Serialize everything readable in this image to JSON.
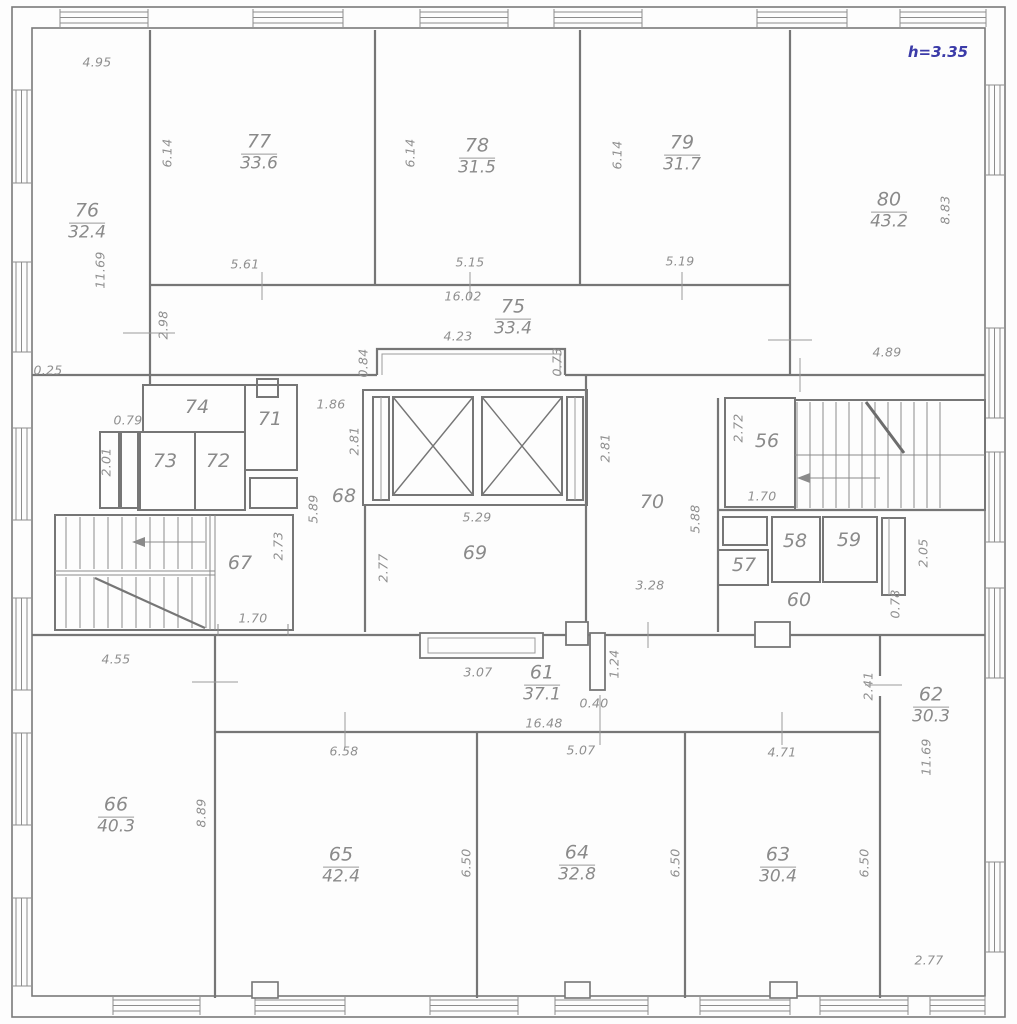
{
  "plan": {
    "height_note": "h=3.35",
    "accent_color": "#3b3ba8",
    "line_color": "#767676"
  },
  "rooms": [
    {
      "number": "76",
      "area": "32.4",
      "x": 87,
      "y": 222
    },
    {
      "number": "77",
      "area": "33.6",
      "x": 259,
      "y": 153
    },
    {
      "number": "78",
      "area": "31.5",
      "x": 477,
      "y": 157
    },
    {
      "number": "79",
      "area": "31.7",
      "x": 682,
      "y": 154
    },
    {
      "number": "80",
      "area": "43.2",
      "x": 889,
      "y": 211
    },
    {
      "number": "75",
      "area": "33.4",
      "x": 513,
      "y": 318
    },
    {
      "number": "66",
      "area": "40.3",
      "x": 116,
      "y": 816
    },
    {
      "number": "65",
      "area": "42.4",
      "x": 341,
      "y": 866
    },
    {
      "number": "64",
      "area": "32.8",
      "x": 577,
      "y": 864
    },
    {
      "number": "63",
      "area": "30.4",
      "x": 778,
      "y": 866
    },
    {
      "number": "62",
      "area": "30.3",
      "x": 931,
      "y": 706
    },
    {
      "number": "61",
      "area": "37.1",
      "x": 542,
      "y": 684
    }
  ],
  "small_rooms": [
    {
      "number": "74",
      "x": 197,
      "y": 407
    },
    {
      "number": "71",
      "x": 270,
      "y": 419
    },
    {
      "number": "73",
      "x": 165,
      "y": 461
    },
    {
      "number": "72",
      "x": 218,
      "y": 461
    },
    {
      "number": "68",
      "x": 344,
      "y": 496
    },
    {
      "number": "69",
      "x": 475,
      "y": 553
    },
    {
      "number": "70",
      "x": 652,
      "y": 502
    },
    {
      "number": "67",
      "x": 240,
      "y": 563
    },
    {
      "number": "56",
      "x": 767,
      "y": 441
    },
    {
      "number": "57",
      "x": 744,
      "y": 565
    },
    {
      "number": "58",
      "x": 795,
      "y": 541
    },
    {
      "number": "59",
      "x": 849,
      "y": 540
    },
    {
      "number": "60",
      "x": 799,
      "y": 600
    }
  ],
  "dimensions": [
    {
      "value": "4.95",
      "x": 97,
      "y": 62,
      "rot": false
    },
    {
      "value": "6.14",
      "x": 167,
      "y": 153,
      "rot": true
    },
    {
      "value": "6.14",
      "x": 410,
      "y": 153,
      "rot": true
    },
    {
      "value": "6.14",
      "x": 617,
      "y": 155,
      "rot": true
    },
    {
      "value": "8.83",
      "x": 945,
      "y": 210,
      "rot": true
    },
    {
      "value": "11.69",
      "x": 100,
      "y": 270,
      "rot": true
    },
    {
      "value": "5.61",
      "x": 245,
      "y": 264,
      "rot": false
    },
    {
      "value": "5.15",
      "x": 470,
      "y": 262,
      "rot": false
    },
    {
      "value": "5.19",
      "x": 680,
      "y": 261,
      "rot": false
    },
    {
      "value": "16.02",
      "x": 463,
      "y": 296,
      "rot": false
    },
    {
      "value": "4.23",
      "x": 458,
      "y": 336,
      "rot": false
    },
    {
      "value": "0.84",
      "x": 363,
      "y": 363,
      "rot": true
    },
    {
      "value": "0.73",
      "x": 557,
      "y": 362,
      "rot": true
    },
    {
      "value": "2.98",
      "x": 163,
      "y": 325,
      "rot": true
    },
    {
      "value": "0.25",
      "x": 48,
      "y": 370,
      "rot": false
    },
    {
      "value": "4.89",
      "x": 887,
      "y": 352,
      "rot": false
    },
    {
      "value": "1.86",
      "x": 331,
      "y": 404,
      "rot": false
    },
    {
      "value": "0.79",
      "x": 128,
      "y": 420,
      "rot": false
    },
    {
      "value": "2.01",
      "x": 106,
      "y": 462,
      "rot": true
    },
    {
      "value": "2.81",
      "x": 354,
      "y": 441,
      "rot": true
    },
    {
      "value": "2.81",
      "x": 605,
      "y": 448,
      "rot": true
    },
    {
      "value": "5.89",
      "x": 313,
      "y": 509,
      "rot": true
    },
    {
      "value": "5.88",
      "x": 695,
      "y": 519,
      "rot": true
    },
    {
      "value": "5.29",
      "x": 477,
      "y": 517,
      "rot": false
    },
    {
      "value": "2.77",
      "x": 383,
      "y": 568,
      "rot": true
    },
    {
      "value": "3.28",
      "x": 650,
      "y": 585,
      "rot": false
    },
    {
      "value": "2.72",
      "x": 738,
      "y": 428,
      "rot": true
    },
    {
      "value": "1.70",
      "x": 762,
      "y": 496,
      "rot": false
    },
    {
      "value": "2.73",
      "x": 278,
      "y": 546,
      "rot": true
    },
    {
      "value": "1.70",
      "x": 253,
      "y": 618,
      "rot": false
    },
    {
      "value": "2.05",
      "x": 923,
      "y": 553,
      "rot": true
    },
    {
      "value": "0.78",
      "x": 895,
      "y": 604,
      "rot": true
    },
    {
      "value": "4.55",
      "x": 116,
      "y": 659,
      "rot": false
    },
    {
      "value": "8.89",
      "x": 201,
      "y": 813,
      "rot": true
    },
    {
      "value": "3.07",
      "x": 478,
      "y": 672,
      "rot": false
    },
    {
      "value": "1.24",
      "x": 614,
      "y": 664,
      "rot": true
    },
    {
      "value": "0.40",
      "x": 594,
      "y": 703,
      "rot": false
    },
    {
      "value": "16.48",
      "x": 544,
      "y": 723,
      "rot": false
    },
    {
      "value": "5.07",
      "x": 581,
      "y": 750,
      "rot": false
    },
    {
      "value": "6.58",
      "x": 344,
      "y": 751,
      "rot": false
    },
    {
      "value": "4.71",
      "x": 782,
      "y": 752,
      "rot": false
    },
    {
      "value": "6.50",
      "x": 466,
      "y": 863,
      "rot": true
    },
    {
      "value": "6.50",
      "x": 675,
      "y": 863,
      "rot": true
    },
    {
      "value": "6.50",
      "x": 864,
      "y": 863,
      "rot": true
    },
    {
      "value": "2.41",
      "x": 868,
      "y": 686,
      "rot": true
    },
    {
      "value": "11.69",
      "x": 926,
      "y": 757,
      "rot": true
    },
    {
      "value": "2.77",
      "x": 929,
      "y": 960,
      "rot": false
    }
  ]
}
